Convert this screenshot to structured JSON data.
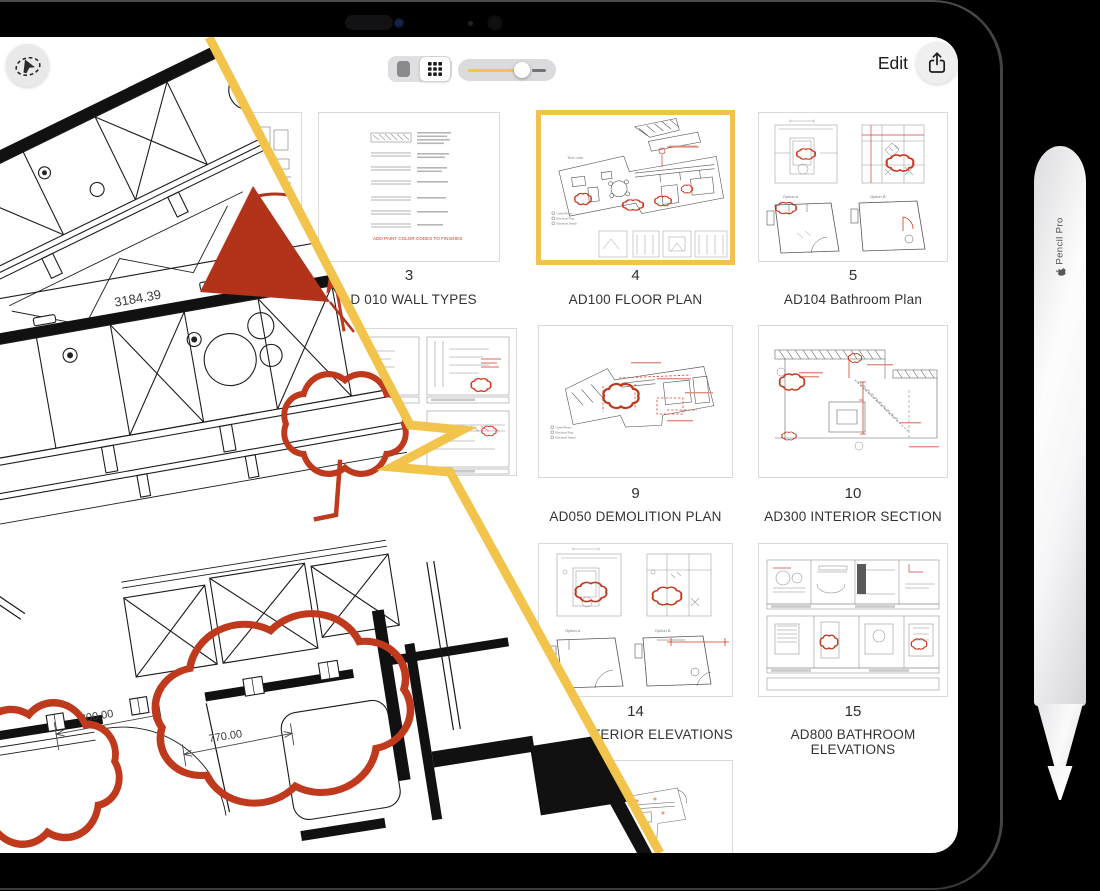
{
  "header": {
    "edit_label": "Edit"
  },
  "pages": [
    {
      "number": "3",
      "title": "AD 010 WALL TYPES",
      "red_note": "ADD PAINT COLOR CODES TO FINISHES"
    },
    {
      "number": "4",
      "title": "AD100 FLOOR PLAN",
      "selected": true,
      "note": "Text note",
      "legend": [
        "Cable/Phone",
        "Electrical Plug",
        "Electrical Switch"
      ]
    },
    {
      "number": "5",
      "title": "AD104 Bathroom Plan",
      "option_a": "Option A",
      "option_b": "Option B"
    },
    {
      "number": "9",
      "title": "AD050 DEMOLITION PLAN",
      "legend": [
        "Cable/Phone",
        "Electrical Plug",
        "Electrical Switch"
      ]
    },
    {
      "number": "10",
      "title": "AD300 INTERIOR SECTION"
    },
    {
      "number": "14",
      "title_visible": "INTERIOR ELEVATIONS",
      "option_a": "Option A",
      "option_b": "Option B"
    },
    {
      "number": "15",
      "title": "AD800 BATHROOM ELEVATIONS"
    },
    {
      "title_visible": "S"
    }
  ],
  "overlay": {
    "dim_counter": "3184.39",
    "dim_opening": "800.00",
    "dim_door": "770.00"
  },
  "pencil": {
    "brand": "Pencil Pro"
  },
  "colors": {
    "accent_yellow": "#F3C44C",
    "selection_border": "#F2C14E",
    "markup_red": "#BE3A1D"
  }
}
